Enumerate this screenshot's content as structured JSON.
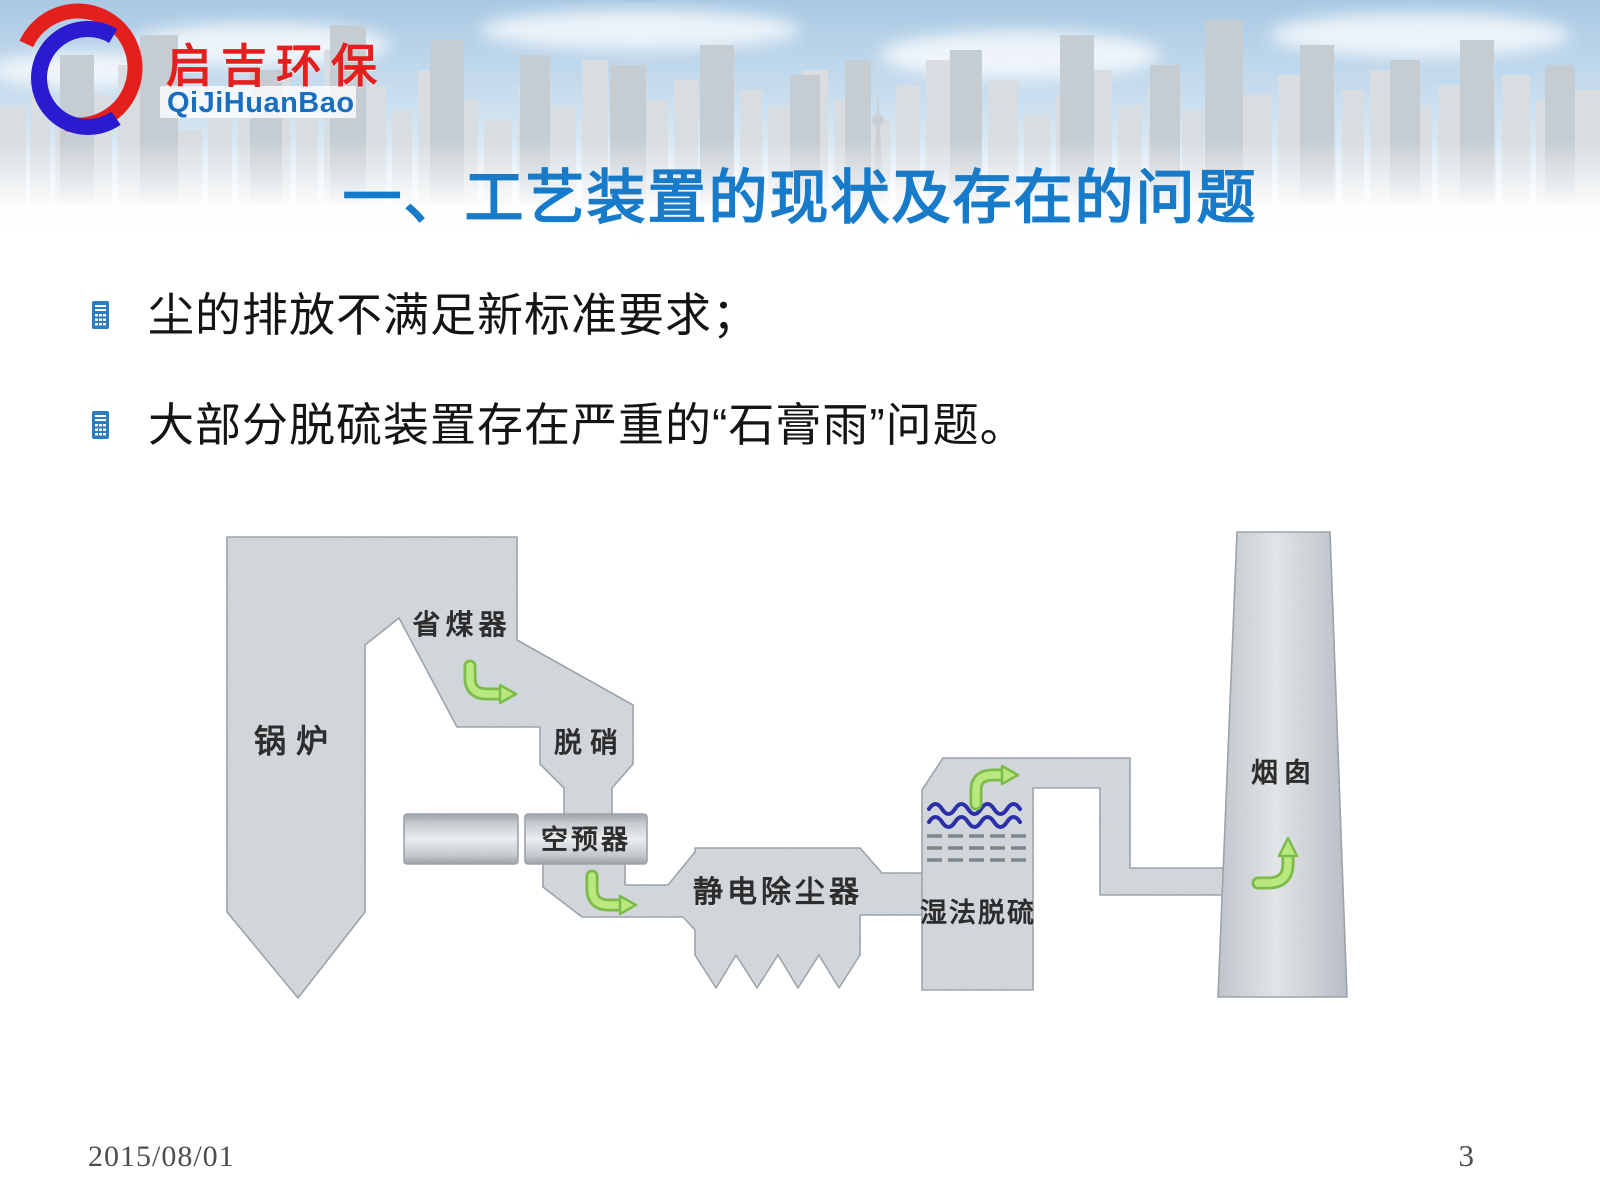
{
  "logo": {
    "brand_cn": "启吉环保",
    "brand_en": "QiJiHuanBao",
    "red": "#e3201d",
    "blue": "#1a6ec0",
    "swirl_red": "#e3201d",
    "swirl_blue": "#2b1bd0"
  },
  "banner": {
    "sky_top_color": "#a9c9e3",
    "building_color": "#c5cdd3"
  },
  "title": {
    "text": "一、工艺装置的现状及存在的问题",
    "color": "#177bca"
  },
  "bullets": [
    {
      "text": "尘的排放不满足新标准要求；"
    },
    {
      "text": "大部分脱硫装置存在严重的“石膏雨”问题。"
    }
  ],
  "bullet_icon": {
    "name": "document-list-icon",
    "color": "#2a7dc0"
  },
  "diagram": {
    "body_fill": "#d2d8dd",
    "body_stroke": "#99a1a8",
    "arrow_fill": "#b9e97e",
    "arrow_stroke": "#7cba4a",
    "wave_color": "#2b2fa8",
    "nodes": [
      {
        "id": "boiler",
        "label": "锅炉"
      },
      {
        "id": "economizer",
        "label": "省煤器"
      },
      {
        "id": "scr-denox",
        "label": "脱硝"
      },
      {
        "id": "air-preheater",
        "label": "空预器"
      },
      {
        "id": "esp",
        "label": "静电除尘器"
      },
      {
        "id": "wet-fgd",
        "label": "湿法脱硫"
      },
      {
        "id": "stack",
        "label": "烟囱"
      }
    ]
  },
  "footer": {
    "date": "2015/08/01",
    "page_number": "3"
  }
}
